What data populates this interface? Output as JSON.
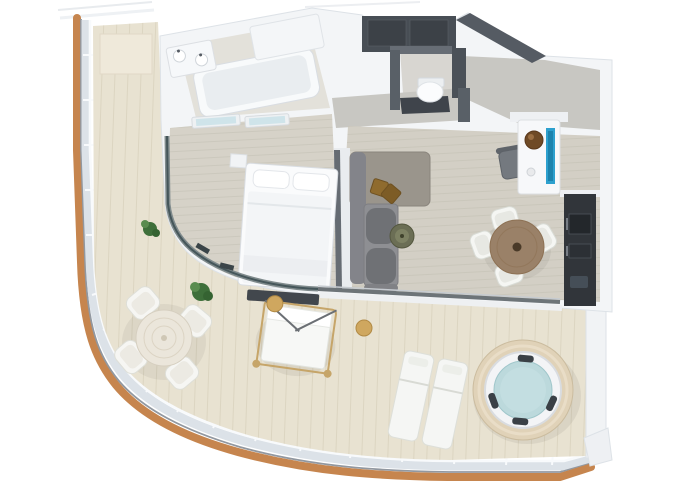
{
  "scene": {
    "kind": "3d-floorplan-render",
    "view": "top-down-dollhouse"
  },
  "palette": {
    "page_bg": "#ffffff",
    "trim_wood": "#c6854e",
    "hull_shadow": "#9298a0",
    "rail_glass": "#dce2e8",
    "rail_white": "#f8fafc",
    "terrace_floor": "#e8e2d1",
    "interior_wall": "#f3f5f7",
    "bathroom_floor": "#e3e1da",
    "bedroom_floor": "#d6d2c8",
    "living_floor": "#d3cfc5",
    "entry_floor": "#c8c7c2",
    "dark_wall": "#555b63",
    "wardrobe_dark": "#484e55",
    "dark_cabinet": "#31353a",
    "sofa_gray": "#8e8f93",
    "sofa_cushion": "#6f7175",
    "chaise_tan": "#9a958c",
    "pillow_bronze": "#8f6b2e",
    "white_furniture": "#f7f8fa",
    "furniture_line": "#dcdfe3",
    "tv_blue": "#2da0ce",
    "bowl_brown": "#6f4a26",
    "dining_wood": "#9a8168",
    "side_table_green": "#6b6e55",
    "plant_green": "#3e6f3a",
    "plant_green_light": "#5a8c4f",
    "gold_post": "#c6a569",
    "tub_water": "#bcd9dc",
    "tub_deck": "#e0d2b8",
    "headrest_dark": "#3a4046",
    "window_glass": "#cfe4ea",
    "glass_dark": "#45565a",
    "door_panel": "#efe9da"
  },
  "rooms": [
    "bathroom",
    "water-closet",
    "entry-hall",
    "bedroom",
    "living-room",
    "dining-area",
    "kitchenette",
    "side-balcony",
    "wraparound-terrace"
  ],
  "furniture": [
    "bathtub",
    "shower",
    "vanity-sinks",
    "toilet",
    "wc-vanity",
    "wardrobe",
    "entry-console",
    "tv",
    "decor-bowl",
    "desk-chair",
    "double-bed",
    "bed-bench",
    "nightstand",
    "sofa",
    "chaise",
    "decor-pillows",
    "side-table",
    "dining-table",
    "dining-chairs",
    "kitchen-counter",
    "terrace-table",
    "terrace-armchairs",
    "potted-plants",
    "canopy-daybed",
    "gold-stools",
    "sun-loungers",
    "hot-tub"
  ]
}
